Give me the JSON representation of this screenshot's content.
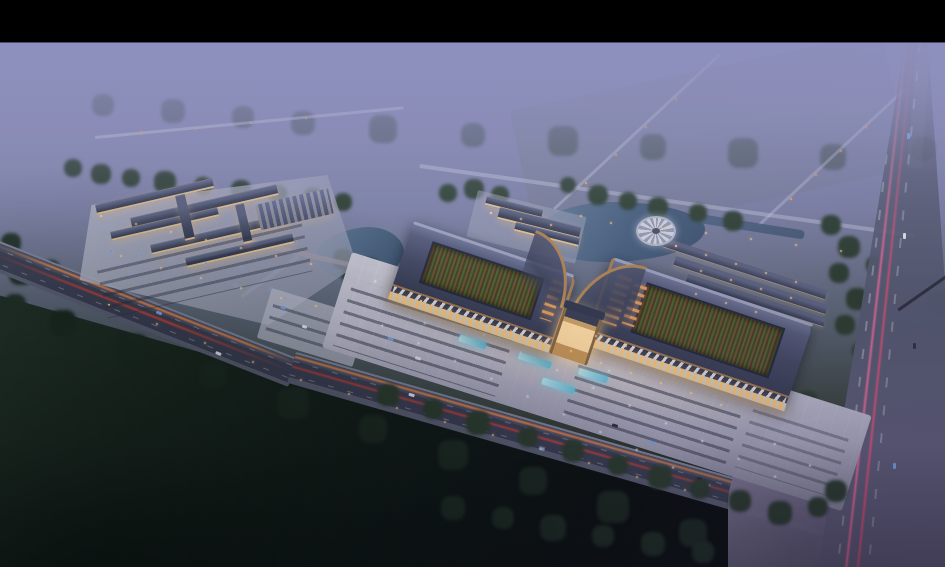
{
  "scene": {
    "description": "Dusk aerial rendering of a Chinese-style market complex: twin curved-roof exhibition halls with sunken green courtyards and bronze trim, a glowing central entrance gate, an illuminated forecourt plaza with fountains and parking rows, a secondary retail campus with lit lanes to the west, villa rows, a pond and a circular waterside plaza to the northeast, all surrounded by misty fields, dark woodland, an arterial boulevard with orange and red light trails, and a wide highway with pink traffic streaks.",
    "visible_text": "none"
  },
  "colors": {
    "letterbox": "#000000",
    "mist": "#8d8fba",
    "skyTop": "#8f91bd",
    "forest": "#2c3e30",
    "forestDark": "#1c2b22",
    "fieldDark": "#0a1110",
    "plaza": "#c9c8da",
    "pavement": "#a8a8be",
    "roofSlate": "#454b66",
    "roofLight": "#767c9c",
    "bronze": "#ab8050",
    "courtGreen": "#55632f",
    "lattice": "#6e5434",
    "warm": "#ffd79a",
    "amber": "#e8a25c",
    "arcade": "#f0ead8",
    "fountain": "#7fd4e8",
    "pond": "#46607e",
    "asphalt": "#3c4156",
    "roadLight": "#6a6f85",
    "trailOrange": "#ff8c4a",
    "trailRed": "#ff4632",
    "trailPink": "#ff6f9e",
    "coolDot": "#eef2ff",
    "carBlue": "#7aa8e8",
    "carWhite": "#e8eaf2",
    "intersection": "#837d9c"
  }
}
